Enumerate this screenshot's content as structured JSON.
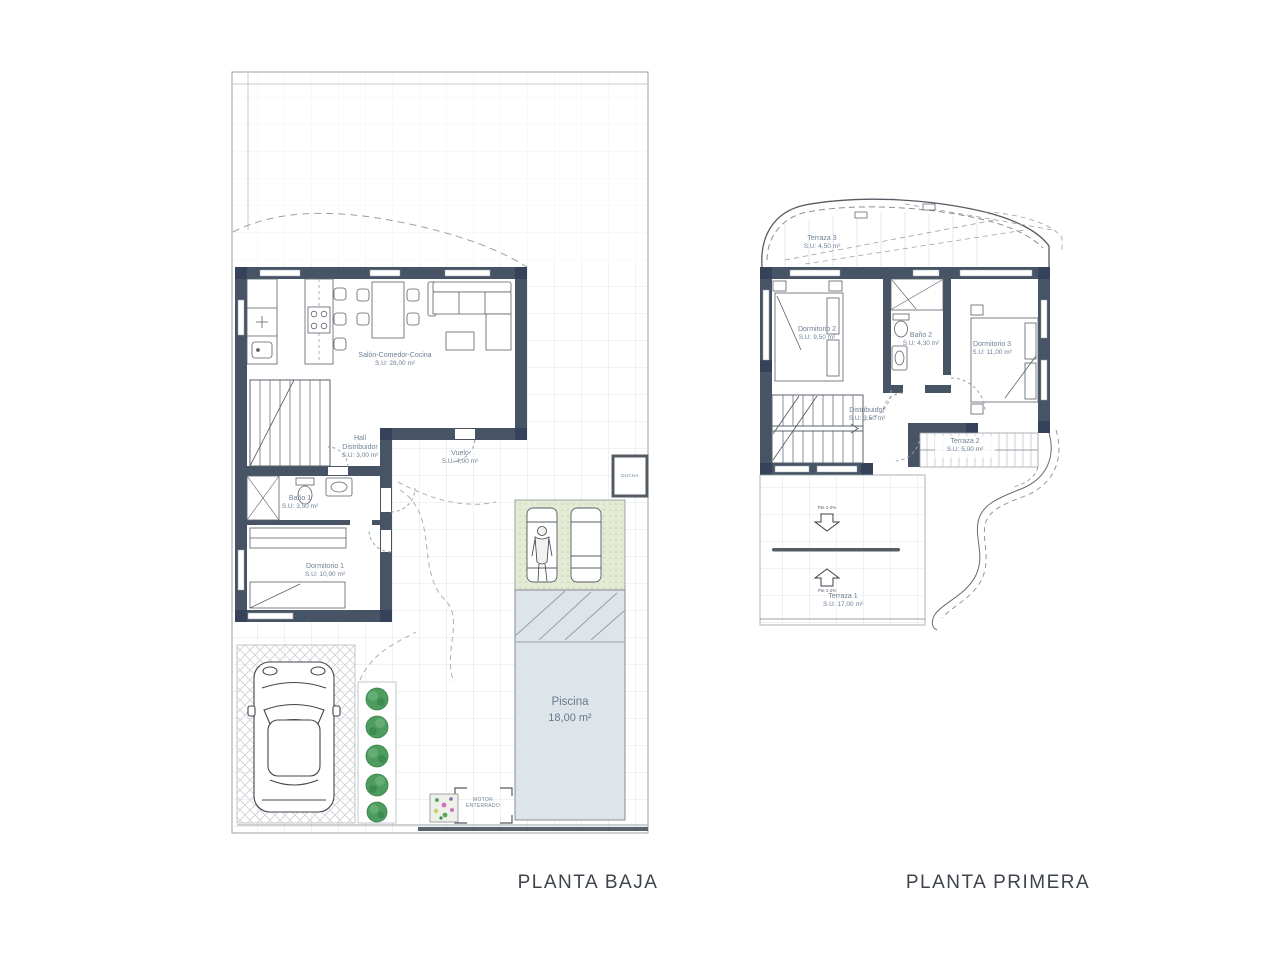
{
  "colors": {
    "wall": "#475466",
    "wall_pillar": "#36425a",
    "label_text": "#6f8196",
    "title_text": "#3e444b",
    "pool_fill": "#dde4ea",
    "deck_fill": "#e3ebd4",
    "plant_green": "#4f9c60",
    "grid_line": "#dadde0",
    "boundary_line": "#9aa0a6"
  },
  "ground_floor": {
    "title": "PLANTA BAJA",
    "rooms": [
      {
        "id": "salon",
        "name": "Salón-Comedor-Cocina",
        "area": "S.U: 28,00 m²"
      },
      {
        "id": "hall",
        "name": "Hall Distribuidor",
        "area": "S.U: 3,00 m²"
      },
      {
        "id": "bano1",
        "name": "Baño 1",
        "area": "S.U: 3,50 m²"
      },
      {
        "id": "dormitorio1",
        "name": "Dormitorio 1",
        "area": "S.U: 10,90 m²"
      },
      {
        "id": "vuelo",
        "name": "Vuelo",
        "area": "S.U: 4,00 m²"
      },
      {
        "id": "piscina",
        "name": "Piscina",
        "area": "18,00 m²"
      }
    ],
    "annotations": {
      "ducha": "DUCHA",
      "motor": "MOTOR ENTERRADO"
    }
  },
  "first_floor": {
    "title": "PLANTA PRIMERA",
    "rooms": [
      {
        "id": "terraza3",
        "name": "Terraza 3",
        "area": "S.U: 4,50 m²"
      },
      {
        "id": "dormitorio2",
        "name": "Dormitorio 2",
        "area": "S.U: 9,50 m²"
      },
      {
        "id": "bano2",
        "name": "Baño 2",
        "area": "S.U: 4,30 m²"
      },
      {
        "id": "dormitorio3",
        "name": "Dormitorio 3",
        "area": "S.U: 11,00 m²"
      },
      {
        "id": "distribuidor",
        "name": "Distribuidor",
        "area": "S.U: 3,50 m²"
      },
      {
        "id": "terraza2",
        "name": "Terraza 2",
        "area": "S.U: 5,00 m²"
      },
      {
        "id": "terraza1",
        "name": "Terraza 1",
        "area": "S.U: 17,00 m²"
      }
    ],
    "slopes": {
      "down": "Pte 1-2%",
      "up": "Pte 1-2%"
    }
  }
}
